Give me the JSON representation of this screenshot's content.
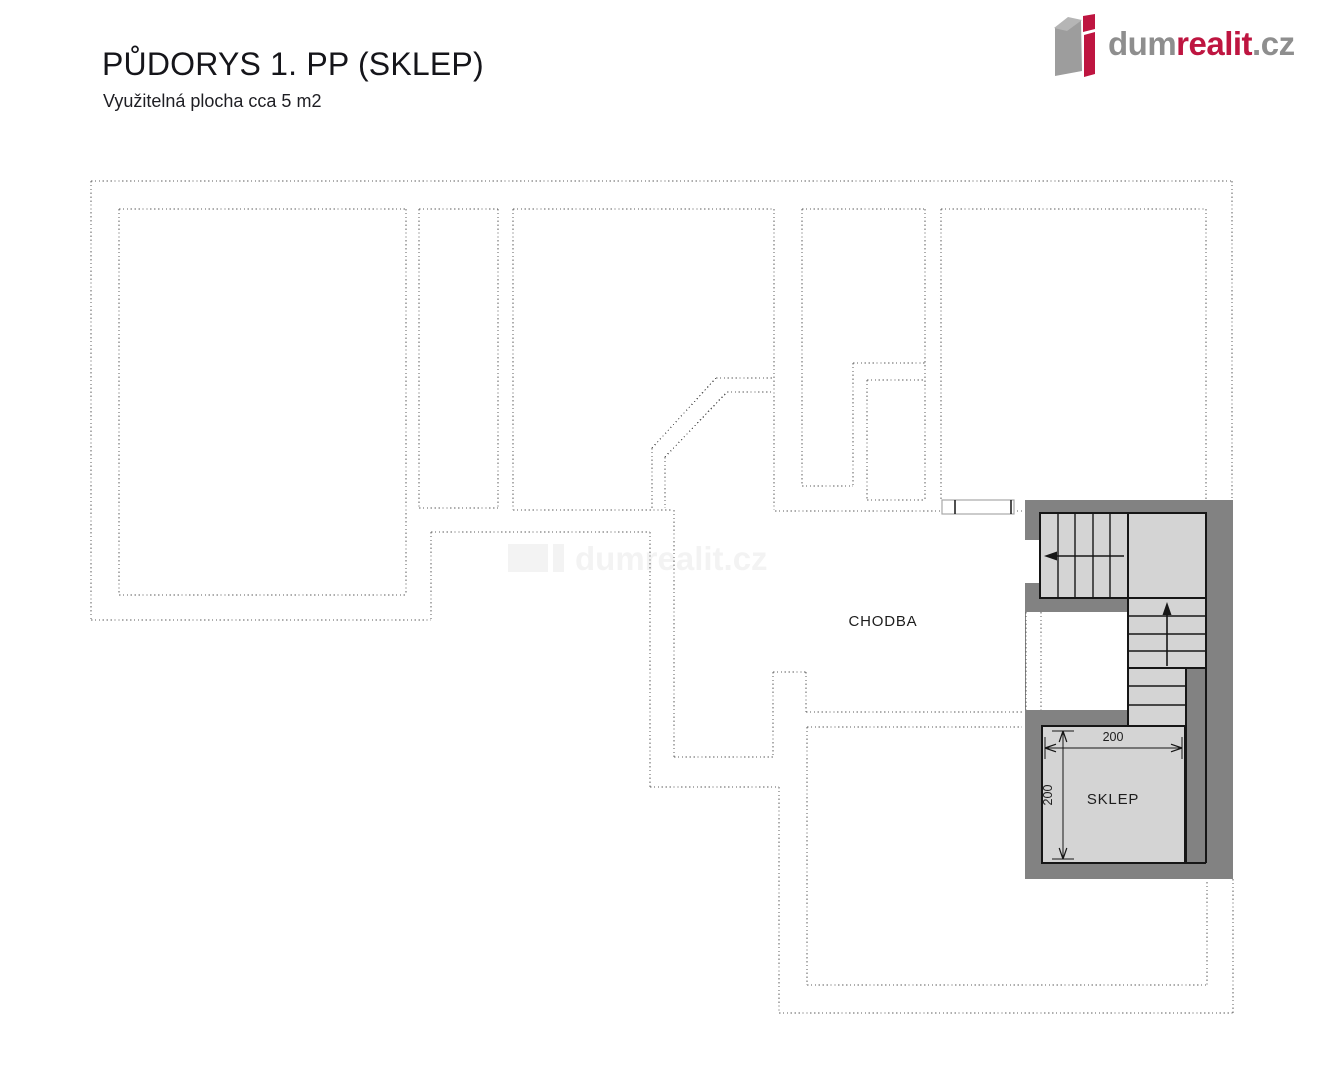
{
  "header": {
    "title": "PŮDORYS 1. PP (SKLEP)",
    "subtitle": "Využitelná plocha cca 5 m2"
  },
  "logo": {
    "part1": "dum",
    "part2": "realit",
    "part3": ".cz",
    "gray": "#8e8e8e",
    "red": "#be1540",
    "icon_body": "#9d9d9d",
    "icon_top": "#b5b5b5",
    "icon_red": "#be1540"
  },
  "watermark": {
    "text": "dumrealit.cz",
    "color": "#f3f3f3",
    "text_x": 575,
    "text_y": 570,
    "font_size": 33,
    "icon_rects": [
      [
        508,
        544,
        40,
        28
      ],
      [
        553,
        544,
        11,
        28
      ]
    ]
  },
  "plan": {
    "colors": {
      "dotted": "#5c5c5c",
      "wall": "#828282",
      "stair_fill": "#d4d4d4",
      "outline": "#161616",
      "white": "#ffffff",
      "door_stroke": "#a8a8a8",
      "label": "#1d1d1d"
    },
    "dotted_segments": [
      [
        91,
        181,
        1232,
        181
      ],
      [
        91,
        181,
        91,
        620
      ],
      [
        91,
        620,
        431,
        620
      ],
      [
        431,
        532,
        431,
        620
      ],
      [
        431,
        532,
        650,
        532
      ],
      [
        650,
        532,
        650,
        787
      ],
      [
        650,
        787,
        779,
        787
      ],
      [
        779,
        787,
        779,
        1013
      ],
      [
        779,
        1013,
        1233,
        1013
      ],
      [
        1233,
        879,
        1233,
        1013
      ],
      [
        1232,
        181,
        1232,
        500
      ],
      [
        119,
        209,
        406,
        209
      ],
      [
        119,
        209,
        119,
        595
      ],
      [
        119,
        595,
        406,
        595
      ],
      [
        406,
        209,
        406,
        595
      ],
      [
        419,
        209,
        498,
        209
      ],
      [
        419,
        209,
        419,
        508
      ],
      [
        419,
        508,
        498,
        508
      ],
      [
        498,
        209,
        498,
        508
      ],
      [
        513,
        209,
        774,
        209
      ],
      [
        513,
        209,
        513,
        510
      ],
      [
        774,
        209,
        774,
        510
      ],
      [
        716,
        378,
        774,
        378
      ],
      [
        727,
        392,
        774,
        392
      ],
      [
        652,
        448,
        716,
        378
      ],
      [
        665,
        457,
        727,
        392
      ],
      [
        652,
        448,
        652,
        508
      ],
      [
        665,
        457,
        665,
        508
      ],
      [
        513,
        510,
        673,
        510
      ],
      [
        674,
        510,
        674,
        757
      ],
      [
        674,
        757,
        773,
        757
      ],
      [
        773,
        672,
        773,
        757
      ],
      [
        773,
        672,
        806,
        672
      ],
      [
        806,
        672,
        806,
        712
      ],
      [
        806,
        712,
        1022,
        712
      ],
      [
        775,
        511,
        941,
        511
      ],
      [
        1013,
        511,
        1023,
        511
      ],
      [
        807,
        727,
        1022,
        727
      ],
      [
        807,
        727,
        807,
        985
      ],
      [
        807,
        985,
        1207,
        985
      ],
      [
        1207,
        882,
        1207,
        985
      ],
      [
        802,
        209,
        925,
        209
      ],
      [
        802,
        209,
        802,
        486
      ],
      [
        925,
        209,
        925,
        500
      ],
      [
        853,
        363,
        925,
        363
      ],
      [
        853,
        363,
        853,
        486
      ],
      [
        802,
        486,
        853,
        486
      ],
      [
        867,
        380,
        925,
        380
      ],
      [
        867,
        380,
        867,
        500
      ],
      [
        867,
        500,
        925,
        500
      ],
      [
        941,
        209,
        1206,
        209
      ],
      [
        941,
        209,
        941,
        500
      ],
      [
        1206,
        209,
        1206,
        500
      ]
    ],
    "wall_block": {
      "x": 1025,
      "y": 500,
      "w": 208,
      "h": 379
    },
    "white_cutouts": [
      {
        "x": 1026,
        "y": 612,
        "w": 102,
        "h": 98
      },
      {
        "x": 1025,
        "y": 540,
        "w": 15,
        "h": 43
      }
    ],
    "dotted_over": [
      [
        1026,
        612,
        1026,
        710
      ],
      [
        1041,
        612,
        1041,
        710
      ]
    ],
    "stair_rects": [
      {
        "x": 1040,
        "y": 513,
        "w": 88,
        "h": 85
      },
      {
        "x": 1128,
        "y": 513,
        "w": 78,
        "h": 85
      },
      {
        "x": 1128,
        "y": 598,
        "w": 78,
        "h": 70
      },
      {
        "x": 1128,
        "y": 668,
        "w": 58,
        "h": 58
      },
      {
        "x": 1042,
        "y": 726,
        "w": 143,
        "h": 137
      }
    ],
    "black_lines": [
      [
        1186,
        726,
        1186,
        863
      ],
      [
        1206,
        668,
        1206,
        863
      ],
      [
        1185,
        863,
        1206,
        863
      ]
    ],
    "tread_lines": [
      [
        1058,
        513,
        1058,
        598
      ],
      [
        1075,
        513,
        1075,
        598
      ],
      [
        1093,
        513,
        1093,
        598
      ],
      [
        1110,
        513,
        1110,
        598
      ],
      [
        1128,
        616,
        1206,
        616
      ],
      [
        1128,
        634,
        1206,
        634
      ],
      [
        1128,
        651,
        1206,
        651
      ],
      [
        1128,
        686,
        1186,
        686
      ],
      [
        1128,
        705,
        1186,
        705
      ]
    ],
    "arrows": [
      {
        "line": [
          1124,
          556,
          1052,
          556
        ],
        "head": "1044,556 1057,551.5 1057,560.5"
      },
      {
        "line": [
          1167,
          666,
          1167,
          612
        ],
        "head": "1167,602 1162.5,615 1171.5,615"
      }
    ],
    "door": {
      "x": 942,
      "y": 500,
      "w": 72,
      "h": 14,
      "ticks": [
        [
          955,
          500,
          955,
          514
        ],
        [
          1011,
          500,
          1011,
          514
        ]
      ]
    },
    "dims": {
      "lines": [
        [
          1045,
          748,
          1182,
          748
        ],
        [
          1063,
          731,
          1063,
          859
        ]
      ],
      "witness": [
        [
          1045,
          737,
          1045,
          759
        ],
        [
          1182,
          737,
          1182,
          759
        ],
        [
          1052,
          731,
          1074,
          731
        ],
        [
          1052,
          859,
          1074,
          859
        ]
      ],
      "head_lines": [
        [
          1045,
          748,
          1056,
          744.2
        ],
        [
          1045,
          748,
          1056,
          751.8
        ],
        [
          1182,
          748,
          1171,
          744.2
        ],
        [
          1182,
          748,
          1171,
          751.8
        ],
        [
          1063,
          731,
          1059.2,
          742
        ],
        [
          1063,
          731,
          1066.8,
          742
        ],
        [
          1063,
          859,
          1059.2,
          848
        ],
        [
          1063,
          859,
          1066.8,
          848
        ]
      ],
      "labels": [
        {
          "text": "200",
          "x": 1113,
          "y": 741,
          "rotate": 0
        },
        {
          "text": "200",
          "x": 1052,
          "y": 795,
          "rotate": -90
        }
      ]
    },
    "room_labels": [
      {
        "text": "CHODBA",
        "x": 883,
        "y": 626
      },
      {
        "text": "SKLEP",
        "x": 1113,
        "y": 804
      }
    ]
  }
}
